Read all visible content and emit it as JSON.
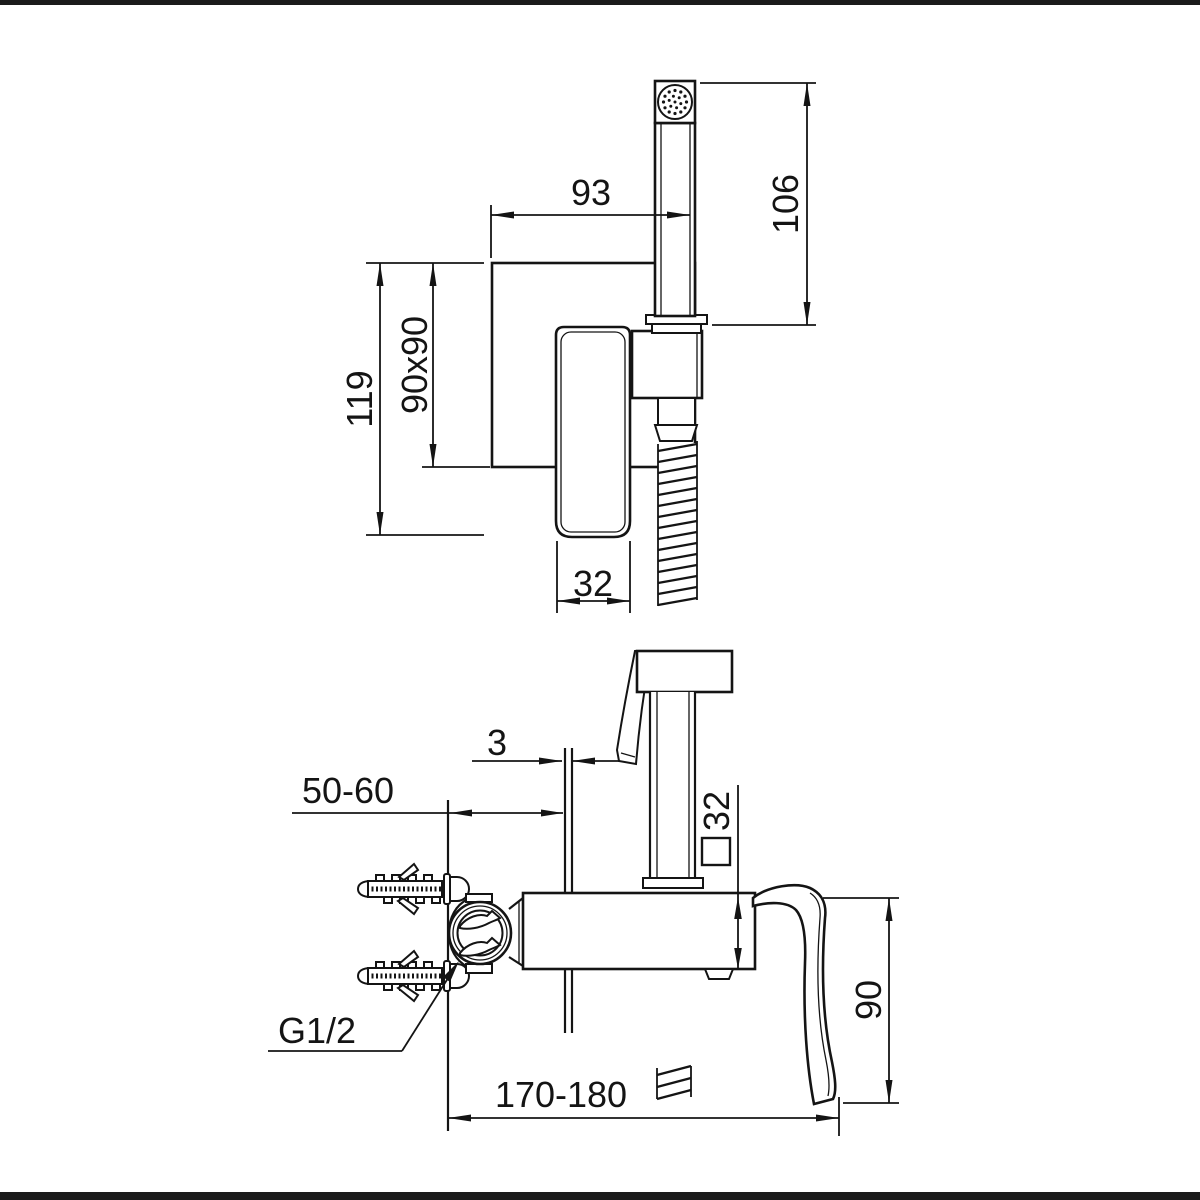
{
  "drawing": {
    "title": "bidet-hand-shower-mixer-installation-drawing",
    "colors": {
      "ink": "#141414",
      "background": "#ffffff",
      "border_bar": "#1b1b1b"
    },
    "dims": {
      "front_width": "93",
      "front_height_106": "106",
      "front_height_119": "119",
      "front_plate": "90x90",
      "front_handle_width": "32",
      "side_plate_thickness": "3",
      "side_wall_distance": "50-60",
      "side_square_section": "32",
      "side_lever_height": "90",
      "side_thread": "G1/2",
      "side_length": "170-180"
    }
  }
}
